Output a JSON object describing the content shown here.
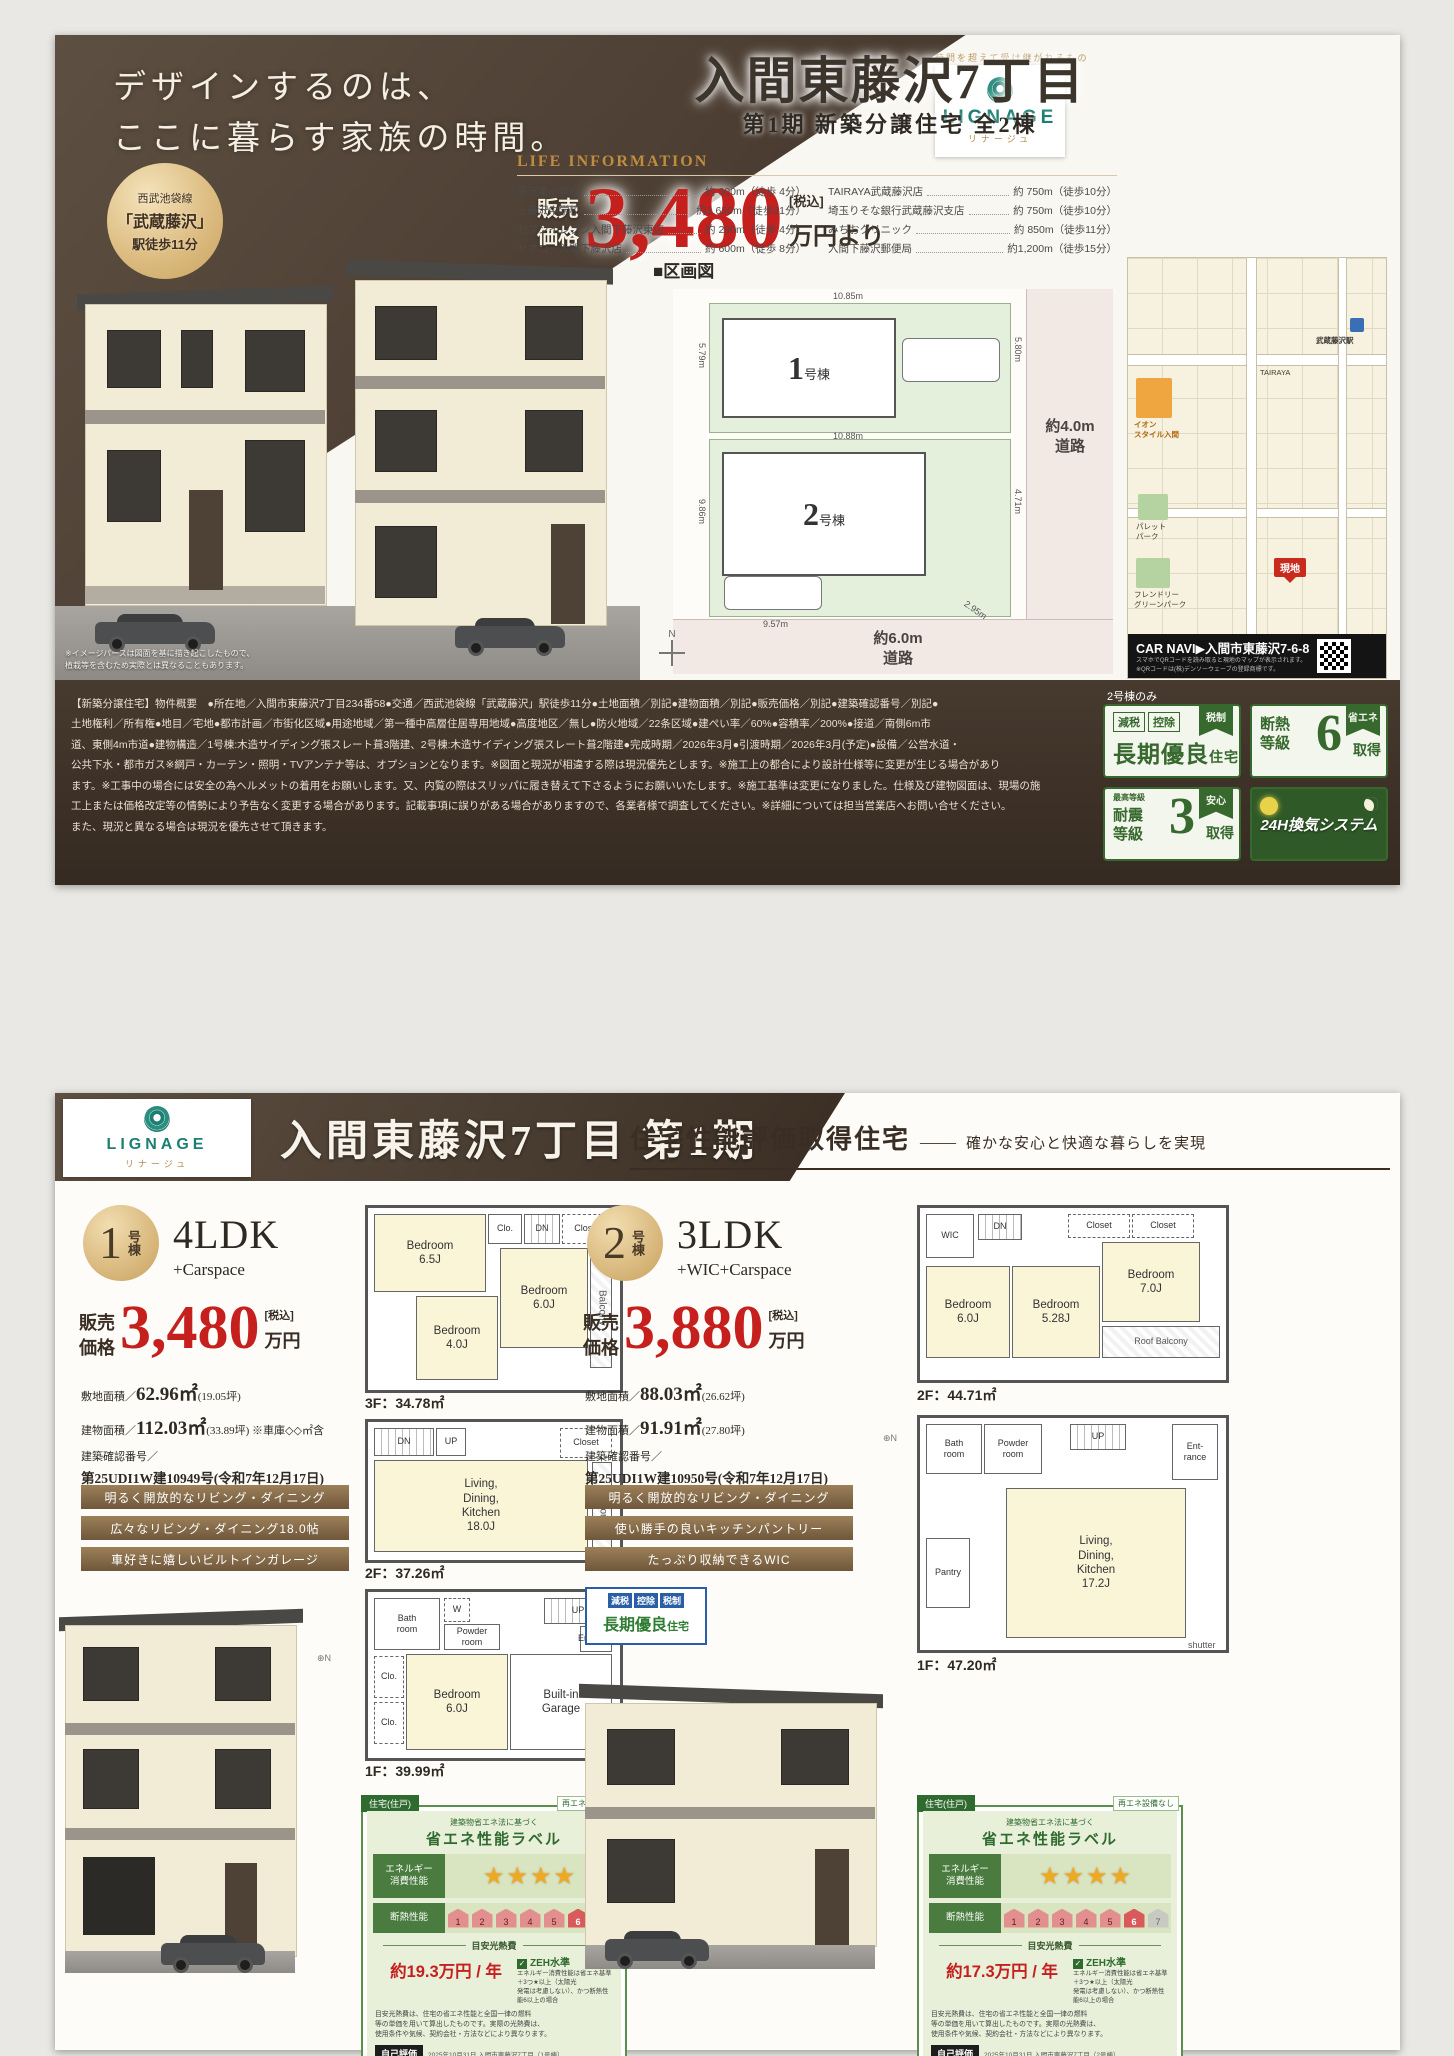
{
  "brand": {
    "tagline": "時間を超えて受け継がれるもの",
    "name": "LIGNAGE",
    "kana": "リナージュ"
  },
  "page1": {
    "catch": "デザインするのは、\nここに暮らす家族の時間。",
    "title": "入間東藤沢7丁目",
    "subtitle": "第1期  新築分譲住宅  全2棟",
    "station": {
      "line": "西武池袋線",
      "name": "「武蔵藤沢」",
      "walk": "駅徒歩11分"
    },
    "price": {
      "label": "販売\n価格",
      "value": "3,480",
      "tax": "[税込]",
      "unit": "万円より"
    },
    "life": {
      "heading": "LIFE INFORMATION",
      "left": [
        {
          "n": "藤沢東小学校",
          "d": "約 300m（徒歩 4分）"
        },
        {
          "n": "上藤沢中学校",
          "d": "約1,650m（徒歩21分）"
        },
        {
          "n": "セブンイレブン入間下藤沢東店",
          "d": "約 290m（徒歩 4分）"
        },
        {
          "n": "ヤオコー入間下藤沢店",
          "d": "約 600m（徒歩 8分）"
        }
      ],
      "right": [
        {
          "n": "TAIRAYA武蔵藤沢店",
          "d": "約 750m（徒歩10分）"
        },
        {
          "n": "埼玉りそな銀行武蔵藤沢支店",
          "d": "約 750m（徒歩10分）"
        },
        {
          "n": "みちおクリニック",
          "d": "約 850m（徒歩11分）"
        },
        {
          "n": "入間下藤沢郵便局",
          "d": "約1,200m（徒歩15分）"
        }
      ]
    },
    "render_note": "※イメージパースは図面を基に描き起こしたもので、\n植栽等を含むため実際とは異なることもあります。",
    "siteplan": {
      "heading": "■区画図",
      "lot1": "1",
      "lot1_suffix": "号棟",
      "lot2": "2",
      "lot2_suffix": "号棟",
      "d_lot1_top": "10.85m",
      "d_lot1_left": "5.79m",
      "d_lot1_right": "5.80m",
      "d_lot2_top": "10.88m",
      "d_lot2_left": "9.86m",
      "d_lot2_right": "4.71m",
      "d_lot2_diag": "2.95m",
      "d_lot2_bottom": "9.57m",
      "road_right": "約4.0m\n道路",
      "road_bottom": "約6.0m\n道路",
      "compass": "N"
    },
    "map": {
      "station": "武蔵藤沢駅",
      "aeon": "イオン\nスタイル入間",
      "tairaya": "TAIRAYA",
      "park1": "パレット\nパーク",
      "park2": "フレンドリー\nグリーンパーク",
      "genchi": "現地",
      "carnavi": "CAR NAVI▶入間市東藤沢7-6-8",
      "qr_note": "スマホでQRコードを読み取ると現地のマップが表示されます。\n※QRコードは(株)デンソーウェーブの登録商標です。"
    },
    "legal_lines": [
      "【新築分譲住宅】物件概要　●所在地／入間市東藤沢7丁目234番58●交通／西武池袋線「武蔵藤沢」駅徒歩11分●土地面積／別記●建物面積／別記●販売価格／別記●建築確認番号／別記●",
      "土地権利／所有権●地目／宅地●都市計画／市街化区域●用途地域／第一種中高層住居専用地域●高度地区／無し●防火地域／22条区域●建ぺい率／60%●容積率／200%●接道／南側6m市",
      "道、東側4m市道●建物構造／1号棟:木造サイディング張スレート葺3階建、2号棟:木造サイディング張スレート葺2階建●完成時期／2026年3月●引渡時期／2026年3月(予定)●設備／公営水道・",
      "公共下水・都市ガス※網戸・カーテン・照明・TVアンテナ等は、オプションとなります。※図面と現況が相違する際は現況優先とします。※施工上の都合により設計仕様等に変更が生じる場合があり",
      "ます。※工事中の場合には安全の為ヘルメットの着用をお願いします。又、内覧の際はスリッパに履き替えて下さるようにお願いいたします。※施工基準は変更になりました。仕様及び建物図面は、現場の施",
      "工上または価格改定等の情勢により予告なく変更する場合があります。記載事項に誤りがある場合がありますので、各業者様で調査してください。※詳細については担当営業店へお問い合せください。",
      "また、現況と異なる場合は現況を優先させて頂きます。"
    ],
    "only2": "2号棟のみ",
    "badges": {
      "b1": {
        "t1": "減税",
        "t2": "控除",
        "ribbon": "税制",
        "main": "長期優良",
        "sub": "住宅"
      },
      "b2": {
        "main": "断熱\n等級",
        "num": "6",
        "ribbon": "省エネ",
        "sub": "取得"
      },
      "b3": {
        "pre": "最高等級",
        "main": "耐震\n等級",
        "num": "3",
        "ribbon": "安心",
        "sub": "取得"
      },
      "b4": {
        "label": "24H換気システム"
      }
    }
  },
  "page2": {
    "title": "入間東藤沢7丁目 第1期",
    "perf": {
      "main": "住宅性能評価取得住宅",
      "dash": "――",
      "sub": "確かな安心と快適な暮らしを実現"
    },
    "labels": {
      "price": "販売\n価格",
      "tax": "[税込]",
      "unit": "万円",
      "land": "敷地面積／",
      "bldg": "建物面積／",
      "kak": "建築確認番号／"
    },
    "b1": {
      "num": "1",
      "num_suffix": "号棟",
      "type": "4LDK",
      "plus": "+Carspace",
      "price": "3,480",
      "land_big": "62.96㎡",
      "land_small": "(19.05坪)",
      "bldg_big": "112.03㎡",
      "bldg_small": "(33.89坪) ※車庫◇◇㎡含",
      "kak": "第25UDI1W建10949号(令和7年12月17日)",
      "tags": [
        "明るく開放的なリビング・ダイニング",
        "広々なリビング・ダイニング18.0帖",
        "車好きに嬉しいビルトインガレージ"
      ]
    },
    "b2": {
      "num": "2",
      "num_suffix": "号棟",
      "type": "3LDK",
      "plus": "+WIC+Carspace",
      "price": "3,880",
      "land_big": "88.03㎡",
      "land_small": "(26.62坪)",
      "bldg_big": "91.91㎡",
      "bldg_small": "(27.80坪)",
      "kak": "第25UDI1W建10950号(令和7年12月17日)",
      "tags": [
        "明るく開放的なリビング・ダイニング",
        "使い勝手の良いキッチンパントリー",
        "たっぷり収納できるWIC"
      ],
      "badge": {
        "t1": "減税",
        "t2": "控除",
        "t3": "税制",
        "main": "長期優良",
        "sub": "住宅"
      }
    },
    "plans": {
      "b1f3": {
        "caption": "3F：34.78㎡",
        "br65": "Bedroom\n6.5J",
        "clo": "Clo.",
        "dn": "DN",
        "closet": "Closet",
        "br40": "Bedroom\n4.0J",
        "br60": "Bedroom\n6.0J",
        "balcony": "Balcony"
      },
      "b1f2": {
        "caption": "2F：37.26㎡",
        "ldk": "Living,\nDining,\nKitchen\n18.0J",
        "closet": "Closet",
        "balcony": "Balcony",
        "dn": "DN",
        "up": "UP"
      },
      "b1f1": {
        "caption": "1F：39.99㎡",
        "bath": "Bath\nroom",
        "w": "W",
        "powder": "Powder\nroom",
        "up": "UP",
        "clo1": "Clo.",
        "clo2": "Clo.",
        "br60": "Bedroom\n6.0J",
        "garage": "Built-in\nGarage",
        "ent": "Entrance"
      },
      "b2f2": {
        "caption": "2F：44.71㎡",
        "wic": "WIC",
        "dn": "DN",
        "closet1": "Closet",
        "closet2": "Closet",
        "br60": "Bedroom\n6.0J",
        "br528": "Bedroom\n5.28J",
        "br70": "Bedroom\n7.0J",
        "roof": "Roof Balcony"
      },
      "b2f1": {
        "caption": "1F：47.20㎡",
        "bath": "Bath\nroom",
        "powder": "Powder\nroom",
        "up": "UP",
        "ent": "Ent-\nrance",
        "pantry": "Pantry",
        "ldk": "Living,\nDining,\nKitchen\n17.2J",
        "shutter": "shutter"
      }
    },
    "energy": {
      "tab": "住宅(住戸)",
      "re": "再エネ設備なし",
      "law": "建築物省エネ法に基づく",
      "title": "省エネ性能ラベル",
      "row1a": "エネルギー",
      "row1b": "消費性能",
      "row2": "断熱性能",
      "stars": "★★★★",
      "scale": [
        "1",
        "2",
        "3",
        "4",
        "5",
        "6",
        "7"
      ],
      "cost_label": "目安光熱費",
      "zeh": "ZEH水準",
      "zeh_note": "エネルギー消費性能は省エネ基準＋3つ★以上（太陽光\n発電は考慮しない）、かつ断熱性能6以上の場合",
      "small": "目安光熱費は、住宅の省エネ性能と全国一律の燃料\n等の単価を用いて算出したものです。実際の光熱費は、\n使用条件や気候、契約会社・方法などにより異なります。",
      "self": "自己評価"
    },
    "energy1": {
      "cost": "約19.3万円 / 年",
      "self_note": "2025年10月31日 入間市東藤沢7丁目（1号棟）",
      "date": "評価日:2025年10月31日"
    },
    "energy2": {
      "cost": "約17.3万円 / 年",
      "self_note": "2025年10月31日 入間市東藤沢7丁目（2号棟）",
      "date": "評価日:2025年10月31日"
    },
    "disclaimer": "省エネ性能ラベルは、特定の住戸の性能を示すものであり、全ての住戸の性能\nを示すものではありません。"
  }
}
